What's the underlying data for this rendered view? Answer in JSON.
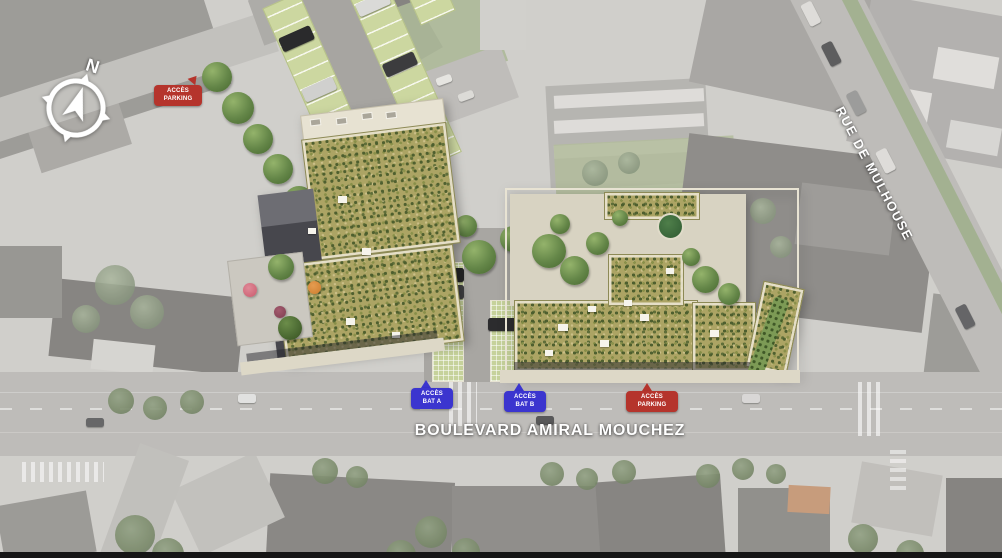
{
  "compass": {
    "north_label": "N"
  },
  "badges": {
    "parking_nw": {
      "line1": "ACCÈS",
      "line2": "PARKING",
      "color": "#b5342c"
    },
    "bat_a": {
      "line1": "ACCÈS",
      "line2": "BAT A",
      "color": "#3b35cf"
    },
    "bat_b": {
      "line1": "ACCÈS",
      "line2": "BAT B",
      "color": "#3b35cf"
    },
    "parking_south": {
      "line1": "ACCÈS",
      "line2": "PARKING",
      "color": "#b5342c"
    }
  },
  "streets": {
    "boulevard": {
      "name": "BOULEVARD AMIRAL MOUCHEZ"
    },
    "rue_mulhouse": {
      "name": "RUE DE MULHOUSE"
    }
  },
  "palette": {
    "badge_blue": "#3b35cf",
    "badge_red": "#b5342c",
    "green_roof": "#aca464",
    "carport_green": "#ccd7a0",
    "road_gray": "#b2b0ac"
  }
}
